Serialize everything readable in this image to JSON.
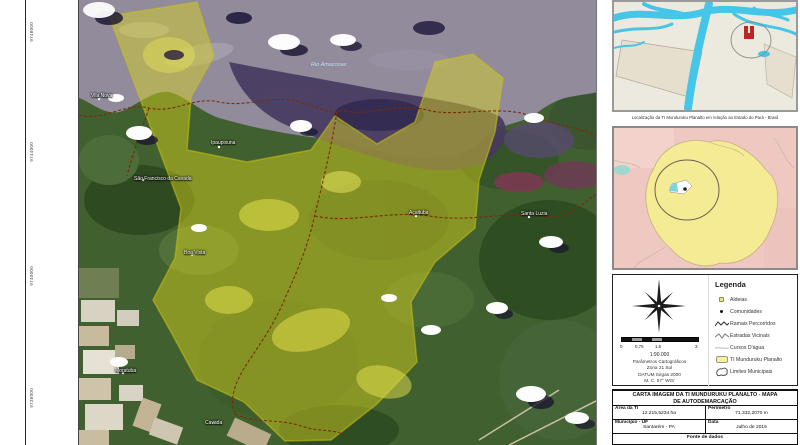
{
  "sheet": {
    "coord_labels": [
      "9748000",
      "9744000",
      "9740000",
      "9736000"
    ]
  },
  "map": {
    "river_label": "Rio Amazonas",
    "labels": [
      {
        "text": "Vila Nova"
      },
      {
        "text": "São Francisco da Cavada"
      },
      {
        "text": "Ipaupixuna"
      },
      {
        "text": "Boa Vista"
      },
      {
        "text": "Açaituba"
      },
      {
        "text": "Santa Luzia"
      },
      {
        "text": "Moratuba"
      },
      {
        "text": "Cavada"
      }
    ]
  },
  "inset_para": {
    "caption": "Localização da TI Munduruku Planalto em relação ao Estado do Pará - Brasil"
  },
  "scale": {
    "ticks": [
      "0",
      "0,75",
      "1,5",
      "3"
    ],
    "ratio": "1:90.000",
    "params_line1": "Parâmetros Cartográficos",
    "params_line2": "Zona 21 Sul",
    "params_line3": "DATUM Sirgas 2000",
    "params_line4": "M. C. 57° WGr"
  },
  "legend": {
    "title": "Legenda",
    "items": [
      {
        "label": "Aldeias"
      },
      {
        "label": "Comunidades"
      },
      {
        "label": "Ramais Percorridos"
      },
      {
        "label": "Estradas Vicinais"
      },
      {
        "label": "Cursos D'água"
      },
      {
        "label": "TI Munduruku Planalto"
      },
      {
        "label": "Limites Municipais"
      }
    ]
  },
  "info": {
    "title_line1": "CARTA IMAGEM DA TI MUNDURUKU PLANALTO - MAPA",
    "title_line2": "DE AUTODEMARCAÇÃO",
    "area_label": "Área da TI",
    "area_value": "12.215,5234 ha",
    "perimeter_label": "Perímetro",
    "perimeter_value": "71.332,2070 m",
    "municipio_label": "Município - UF",
    "municipio_value": "Santarém - PA",
    "date_label": "Data",
    "date_value": "Julho de 2015",
    "source_label": "Fonte de dados"
  },
  "colors": {
    "ti_overlay": "#d8d41c",
    "trail_red": "#7d2906",
    "water_gray": "#918b9c",
    "lake_purple": "#463b60",
    "river_cyan": "#45c6e8",
    "para_yellow": "#f4eb94",
    "neighbor_pink": "#f0c8c2",
    "marker_red": "#c22222"
  }
}
